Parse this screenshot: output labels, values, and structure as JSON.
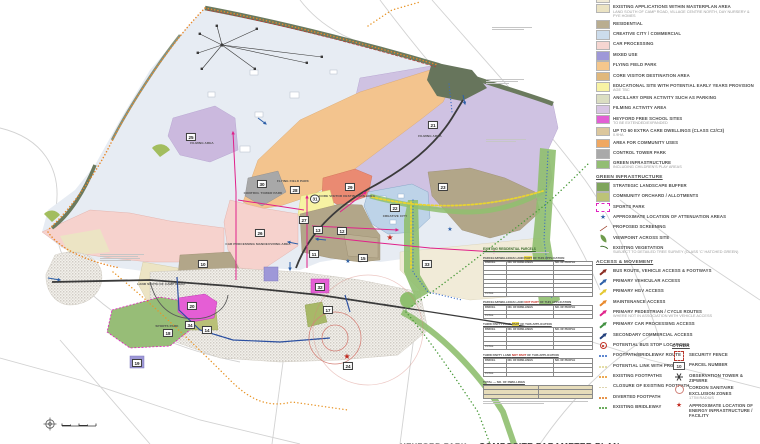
{
  "legend": {
    "landuse_items": [
      {
        "label": "EXISTING COMMERCIAL AREAS",
        "color": "#f0ead6"
      },
      {
        "label": "EXISTING APPLICATIONS WITHIN MASTERPLAN AREA",
        "sub": "LAND SOUTH OF CAMP ROAD, VILLAGE CENTRE NORTH, DAY NURSERY & PYE HOMES",
        "color": "#ebe3c3"
      },
      {
        "label": "RESIDENTIAL",
        "color": "#b9ad90"
      },
      {
        "label": "CREATIVE CITY / COMMERCIAL",
        "color": "#ccdcec"
      },
      {
        "label": "CAR PROCESSING",
        "color": "#f6d6d1"
      },
      {
        "label": "MIXED USE",
        "color": "#9e98d8"
      },
      {
        "label": "FLYING FIELD PARK",
        "color": "#f5c78c"
      },
      {
        "label": "CORE VISITOR DESTINATION AREA",
        "color": "#e0b87c"
      },
      {
        "label": "EDUCATIONAL SITE WITH POTENTIAL EARLY YEARS PROVISION",
        "sub": "AGE TBC",
        "color": "#f8f3a4"
      },
      {
        "label": "ANCILLARY OPEN ACTIVITY SUCH AS PARKING",
        "color": "#dbdec2"
      },
      {
        "label": "FILMING ACTIVITY AREA",
        "color": "#d8c5e4"
      },
      {
        "label": "HEYFORD FREE SCHOOL SITES",
        "sub": "TO BE EXTENDED/EXPANDED",
        "color": "#e25fd4"
      },
      {
        "label": "UP TO 60 EXTRA CARE DWELLINGS (CLASS C2/C3)",
        "sub": "0.9HA",
        "color": "#dcc79d"
      },
      {
        "label": "AREA FOR COMMUNITY USES",
        "color": "#f0a862"
      },
      {
        "label": "CONTROL TOWER PARK",
        "color": "#a9a9a9"
      },
      {
        "label": "GREEN INFRASTRUCTURE",
        "sub": "INCLUDING CHILDREN'S PLAY AREAS",
        "color": "#93bd73"
      }
    ],
    "green_header": "GREEN INFRASTRUCTURE",
    "green_items": [
      {
        "label": "STRATEGIC LANDSCAPE BUFFER",
        "color": "#7fa55c"
      },
      {
        "label": "COMMUNITY ORCHARD / ALLOTMENTS",
        "color": "#bcc377"
      },
      {
        "label": "SPORTS PARK",
        "icon": "sports"
      },
      {
        "label": "APPROXIMATE LOCATION OF ATTENUATION AREAS",
        "icon": "star",
        "color": "#2c5fa8"
      },
      {
        "label": "PROPOSED SCREENING",
        "icon": "screening"
      },
      {
        "label": "VIEWPOINT ACROSS SITE",
        "icon": "viewpoint"
      },
      {
        "label": "EXISTING VEGETATION",
        "sub": "SUBJECT TO DETAILED TREE SURVEY (CLASS 'C' HATCHED GREEN)",
        "icon": "vegetation"
      }
    ],
    "access_header": "ACCESS & MOVEMENT",
    "access_items": [
      {
        "label": "BUS ROUTE, VEHICLE ACCESS & FOOTWAYS",
        "icon": "arrow",
        "color": "#8a2a20"
      },
      {
        "label": "PRIMARY VEHICULAR ACCESS",
        "icon": "arrow",
        "color": "#2c5fa8"
      },
      {
        "label": "PRIMARY HGV ACCESS",
        "icon": "arrow",
        "color": "#e3c72f"
      },
      {
        "label": "MAINTENANCE ACCESS",
        "icon": "arrow",
        "color": "#e8882a"
      },
      {
        "label": "PRIMARY PEDESTRIAN / CYCLE ROUTES",
        "sub": "WHERE NOT IN ASSOCIATION WITH VEHICLE ACCESS",
        "icon": "arrow",
        "color": "#e0218a"
      },
      {
        "label": "PRIMARY CAR PROCESSING ACCESS",
        "icon": "arrow",
        "color": "#3f8f3f"
      },
      {
        "label": "SECONDARY COMMERCIAL ACCESS",
        "icon": "arrow",
        "color": "#1f3d7a"
      },
      {
        "label": "POTENTIAL BUS STOP LOCATIONS",
        "icon": "busstop"
      },
      {
        "label": "FOOTPATH/BRIDLEWAY ROUTE",
        "icon": "dots",
        "color": "#3a6bc4"
      },
      {
        "label": "POTENTIAL LINK WITH PROW",
        "icon": "dots",
        "color": "#ded592"
      },
      {
        "label": "EXISTING FOOTPATHS",
        "icon": "dots",
        "color": "#e8962a"
      },
      {
        "label": "CLOSURE OF EXISTING FOOTPATH",
        "icon": "dots",
        "color": "#d9cfa4"
      },
      {
        "label": "DIVERTED FOOTPATH",
        "icon": "dots",
        "color": "#e07b22"
      },
      {
        "label": "EXISTING BRIDLEWAY",
        "icon": "dots",
        "color": "#4a9a3a"
      }
    ],
    "other_header": "OTHER",
    "other_items": [
      {
        "label": "SECURITY FENCE",
        "icon": "fence"
      },
      {
        "label": "PARCEL NUMBER",
        "icon": "parcelbox",
        "text": "10"
      },
      {
        "label": "OBSERVATION TOWER & ZIPWIRE",
        "icon": "asterisk"
      },
      {
        "label": "CORDON SANITAIRE EXCLUSION ZONES",
        "sub": "177M RADIUS",
        "icon": "cordon"
      },
      {
        "label": "APPROXIMATE LOCATION OF ENERGY INFRASTRUCTURE / FACILITY",
        "icon": "redstar"
      }
    ]
  },
  "map": {
    "parcels": [
      {
        "n": "25",
        "x": 191,
        "y": 137
      },
      {
        "n": "28",
        "x": 295,
        "y": 190
      },
      {
        "n": "30",
        "x": 262,
        "y": 184
      },
      {
        "n": "29",
        "x": 350,
        "y": 187
      },
      {
        "n": "31",
        "x": 315,
        "y": 199,
        "round": true
      },
      {
        "n": "27",
        "x": 304,
        "y": 220
      },
      {
        "n": "26",
        "x": 260,
        "y": 233
      },
      {
        "n": "21",
        "x": 433,
        "y": 125
      },
      {
        "n": "12",
        "x": 342,
        "y": 231
      },
      {
        "n": "13",
        "x": 318,
        "y": 230
      },
      {
        "n": "11",
        "x": 314,
        "y": 254
      },
      {
        "n": "15",
        "x": 363,
        "y": 258
      },
      {
        "n": "22",
        "x": 395,
        "y": 208
      },
      {
        "n": "23",
        "x": 443,
        "y": 187
      },
      {
        "n": "33",
        "x": 427,
        "y": 264
      },
      {
        "n": "10",
        "x": 203,
        "y": 264
      },
      {
        "n": "20",
        "x": 192,
        "y": 306
      },
      {
        "n": "18",
        "x": 168,
        "y": 333
      },
      {
        "n": "34",
        "x": 190,
        "y": 325
      },
      {
        "n": "14",
        "x": 207,
        "y": 330
      },
      {
        "n": "17",
        "x": 328,
        "y": 310
      },
      {
        "n": "24",
        "x": 348,
        "y": 366
      },
      {
        "n": "32",
        "x": 320,
        "y": 287
      },
      {
        "n": "19",
        "x": 137,
        "y": 363
      }
    ],
    "labels": [
      {
        "text": "FLYING FIELD PARK",
        "x": 293,
        "y": 181
      },
      {
        "text": "CONTROL TOWER PARK",
        "x": 263,
        "y": 193
      },
      {
        "text": "CORE VISITOR DESTINATION AREA",
        "x": 347,
        "y": 196
      },
      {
        "text": "FILMING AREA",
        "x": 202,
        "y": 143
      },
      {
        "text": "FILMING AREA",
        "x": 430,
        "y": 136
      },
      {
        "text": "SPORTS PARK",
        "x": 167,
        "y": 326
      },
      {
        "text": "CAR PROCESSING MANOEUVRING AREA",
        "x": 258,
        "y": 244
      },
      {
        "text": "LAND SOUTH OF CAMP ROAD",
        "x": 161,
        "y": 284
      },
      {
        "text": "CREATIVE CITY",
        "x": 395,
        "y": 216
      }
    ]
  },
  "tables": {
    "intro": "EXISTING RESIDENTIAL PARCELS",
    "cols": [
      "PARCEL",
      "NO. OF DWELLINGS",
      "NO. OF PEOPLE"
    ],
    "total_label": "TOTAL",
    "blocks": [
      {
        "pre": "PARCELS/DWELLINGS LAND ",
        "hl": "PART",
        "post": " OF THIS APPLICATION",
        "hlclass": "hl-y",
        "rows": 6
      },
      {
        "pre": "PARCELS/DWELLINGS LAND ",
        "hl": "NOT PART",
        "post": " OF THIS APPLICATION",
        "hlclass": "hl-r",
        "rows": 1
      },
      {
        "pre": "THIRD PARTY LAND ",
        "hl": "PART",
        "post": " OF THIS APPLICATION",
        "hlclass": "hl-y",
        "rows": 3
      },
      {
        "pre": "THIRD PARTY LAND ",
        "hl": "NOT PART",
        "post": " OF THIS APPLICATION",
        "hlclass": "hl-r",
        "rows": 2
      }
    ],
    "summary_rows": 3,
    "summary_col": "NO. OF DWELLINGS"
  },
  "footer": {
    "site": "HEYFORD PARK",
    "dash": "-",
    "title": "COMPOSITE PARAMETER PLAN",
    "rev": "Rev"
  }
}
